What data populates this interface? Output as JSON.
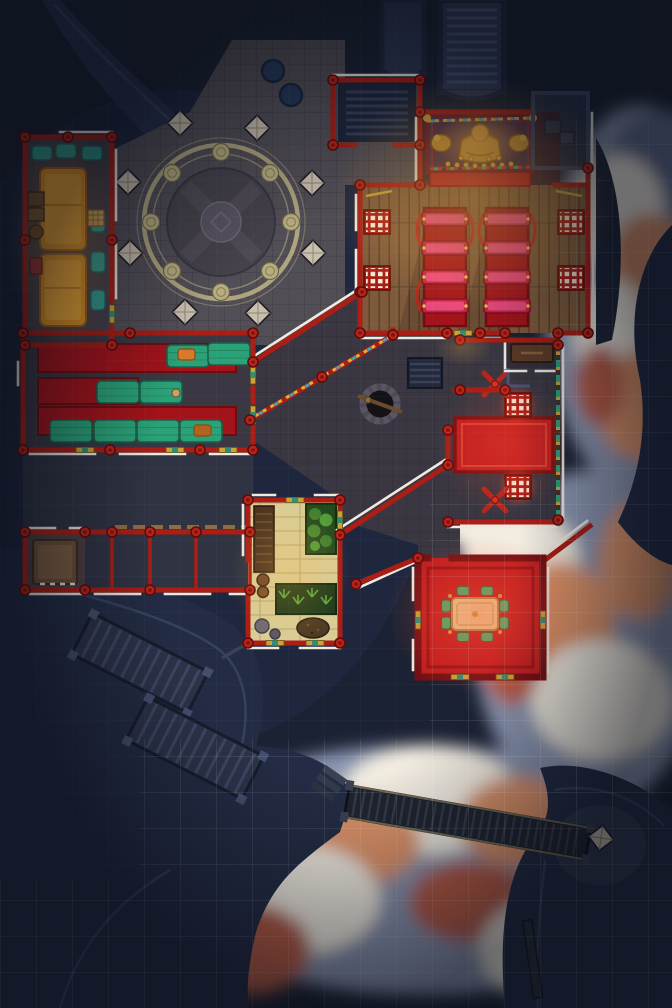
{
  "map": {
    "kind": "top-down fantasy battle map",
    "scene": "mountain monastery perched on cliffs above sunset clouds",
    "grid_px": 36,
    "visible_text": "none"
  },
  "palette": {
    "bg": "#1b2233",
    "rock": "#232c44",
    "rock-light": "#3e4a68",
    "rock-dark": "#151b2c",
    "plaza": "#524e56",
    "plaza-line": "#444048",
    "courtyard": "#3a3742",
    "wall-red": "#ab1d15",
    "wall-deep": "#741014",
    "trim-white": "#efe9df",
    "wood": "#7d5a3c",
    "wood-dark": "#5e422a",
    "carpet-red": "#a3131a",
    "carpet-bright": "#c01d1f",
    "kneeler-pink": "#e8487d",
    "mat-green": "#2aa176",
    "bed-orange": "#f0a833",
    "pillow-teal": "#2f9e94",
    "gold": "#caa23a",
    "gold-bright": "#e3bc4f",
    "altar-purple": "#472a4a",
    "tatami": "#d9cd96",
    "plant": "#4f9c3a",
    "cloud-base": "#8b96b1",
    "cloud-white": "#f2ece1",
    "cloud-warm": "#dd9368",
    "cloud-deep": "#b85c44",
    "cloud-shadow": "#5f6c8e",
    "stair-stone": "#333d5a",
    "glow-warm": "#ffb54d",
    "glow-red": "#ff5a3c",
    "pond": "#24395b",
    "pillar": "#c9bfae"
  },
  "rooms": {
    "dormitory": {
      "name": "dormitory",
      "features": [
        "two orange futon beds",
        "teal pillows",
        "crates",
        "barrel",
        "game board"
      ]
    },
    "plaza": {
      "name": "stone plaza with circular mosaic",
      "features": [
        "double ring mosaic",
        "8 medallions",
        "8 diamond pillars",
        "2 round ponds"
      ]
    },
    "shrine": {
      "name": "shrine alcove",
      "features": [
        "golden buddha statue",
        "two golden lion statues",
        "offering bowls",
        "prayer flag strings",
        "purple altar",
        "red carpet step"
      ]
    },
    "prayer_hall": {
      "name": "prayer hall",
      "features": [
        "wood plank floor",
        "two red aisle carpets",
        "eight pink kneeler benches",
        "four red lattice windows"
      ]
    },
    "meditation_hall": {
      "name": "meditation hall",
      "features": [
        "red carpet runners",
        "green sleeping mats",
        "folded orange robes",
        "small figure"
      ]
    },
    "stairwell": {
      "name": "stairwell room",
      "features": [
        "dark steps"
      ]
    },
    "north_stairs": {
      "name": "north staircase",
      "features": [
        "stone stairs ascending",
        "side walkway"
      ]
    },
    "well_courtyard": {
      "name": "well courtyard",
      "features": [
        "stone well with beam",
        "prayer flag walls",
        "steps"
      ]
    },
    "balcony": {
      "name": "east balcony",
      "features": [
        "red carpet",
        "two glowing braziers",
        "two weapon racks",
        "ornate railing",
        "sideboard alcove"
      ]
    },
    "tea_room": {
      "name": "tea room",
      "features": [
        "low golden table",
        "green cushions",
        "bright red floor",
        "ornate door trims"
      ]
    },
    "garden_room": {
      "name": "garden room",
      "features": [
        "tatami mats",
        "bamboo planter",
        "herb planter",
        "wooden shelf",
        "barrels",
        "stones",
        "dirt pile"
      ]
    },
    "gate_corridor": {
      "name": "gate corridor",
      "features": [
        "torii posts",
        "entry mat room"
      ]
    },
    "cliff_stairs": {
      "name": "cliff stairs",
      "features": [
        "wooden switchback stairs on rock"
      ]
    },
    "bridge": {
      "name": "plank bridge",
      "features": [
        "dark wooden bridge",
        "stone diamond pillar",
        "cloud chasm below"
      ]
    }
  }
}
